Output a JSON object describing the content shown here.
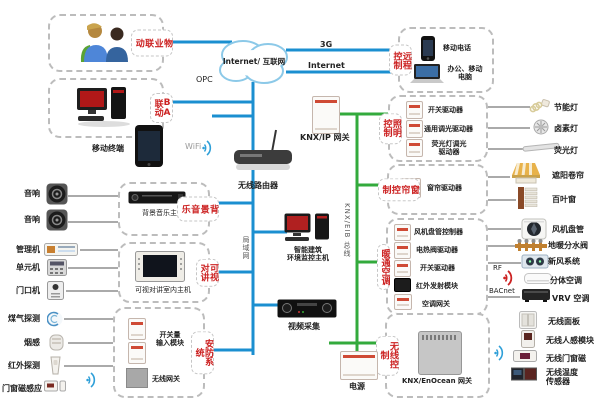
{
  "colors": {
    "line_blue": "#1b8fd0",
    "line_green": "#33aa3c",
    "label_red": "#cc2222",
    "thin_line": "#555555",
    "cloud_stroke": "#8cc9e8",
    "box_border": "#bcbcbc"
  },
  "cloud": {
    "label": "Internet/ 互联网"
  },
  "net": {
    "g3": "3G",
    "internet": "Internet",
    "opc": "OPC",
    "wifi": "WiFi",
    "lan": "局域网",
    "knx_bus": "KNX/EIB 总线",
    "rf": "RF",
    "bacnet": "BACnet"
  },
  "linkage": {
    "property": "物业联动",
    "ba": "BA联动"
  },
  "remote": {
    "tab": "远程控制",
    "phone": "移动电话",
    "computer": "办公、移动\n电脑"
  },
  "core": {
    "knx_ip": "KNX/IP 网关",
    "router": "无线路由器",
    "mobile_terminal": "移动终端",
    "enocean_gw": "KNX/EnOcean 网关",
    "power": "电源",
    "host": "智能建筑\n环境监控主机",
    "video": "视频采集"
  },
  "bgm": {
    "tab": "背景音乐",
    "host": "背景音乐主机"
  },
  "intercom": {
    "tab": "可视对讲",
    "host": "可视对讲室内主机"
  },
  "security": {
    "tab": "安防系统",
    "io": "开关量\n输入模块",
    "wireless_gw": "无线网关"
  },
  "left": {
    "items": [
      "音响",
      "音响",
      "管理机",
      "单元机",
      "门口机",
      "煤气探测",
      "烟感",
      "红外探测",
      "门窗磁感应"
    ]
  },
  "lighting": {
    "tab": "照明控制",
    "devices": [
      "开关驱动器",
      "通用调光驱动器",
      "荧光灯调光\n驱动器"
    ],
    "targets": [
      "节能灯",
      "卤素灯",
      "荧光灯"
    ]
  },
  "curtain": {
    "tab": "窗帘控制",
    "devices": [
      "窗帘驱动器"
    ],
    "targets": [
      "遮阳卷帘",
      "百叶窗"
    ]
  },
  "hvac": {
    "tab": "暖通空调",
    "devices": [
      "风机盘管控制器",
      "电热阀驱动器",
      "开关驱动器",
      "红外发射模块",
      "空调网关"
    ],
    "targets": [
      "风机盘管",
      "地暖分水阀",
      "新风系统",
      "分体空调",
      "VRV 空调"
    ]
  },
  "wireless": {
    "tab": "无线控制",
    "targets": [
      "无线面板",
      "无线人感模块",
      "无线门窗磁",
      "无线温度\n传感器"
    ]
  }
}
